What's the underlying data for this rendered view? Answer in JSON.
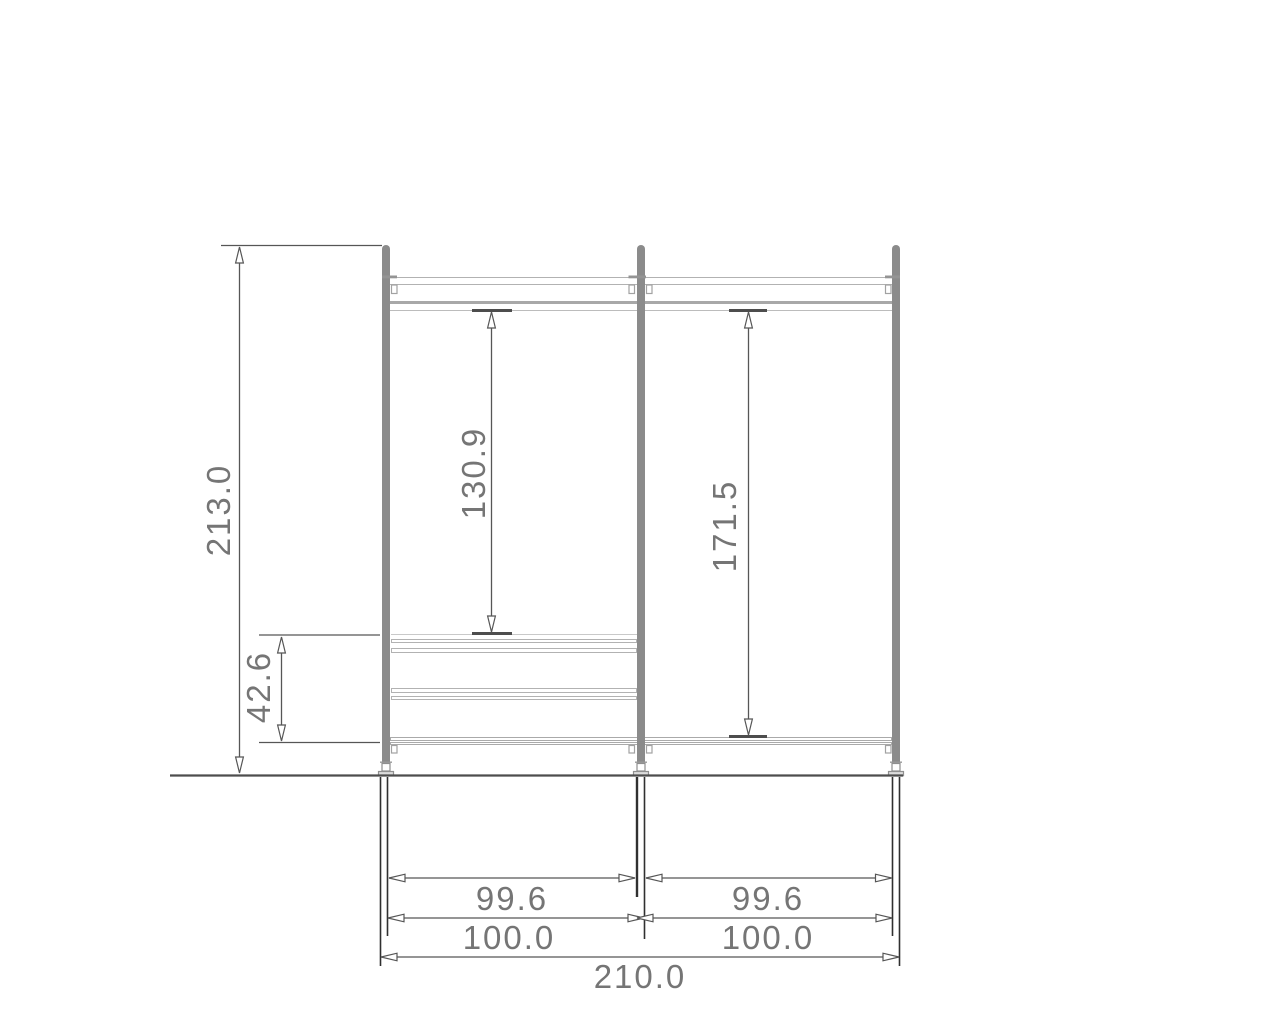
{
  "drawing": {
    "description": "Wardrobe shelving frame front elevation with dimensions",
    "colors": {
      "frame_post": "#8b8b8b",
      "rail_outline": "#b2b2b2",
      "dimension_line": "#565656",
      "dimension_text": "#757575",
      "ground_line": "#4d4d4d"
    },
    "dims": {
      "total_height": "213.0",
      "left_bay_drop": "130.9",
      "right_bay_drop": "171.5",
      "shelf_zone_height": "42.6",
      "left_bay_clear_width": "99.6",
      "right_bay_clear_width": "99.6",
      "left_bay_width": "100.0",
      "right_bay_width": "100.0",
      "total_width": "210.0"
    }
  }
}
